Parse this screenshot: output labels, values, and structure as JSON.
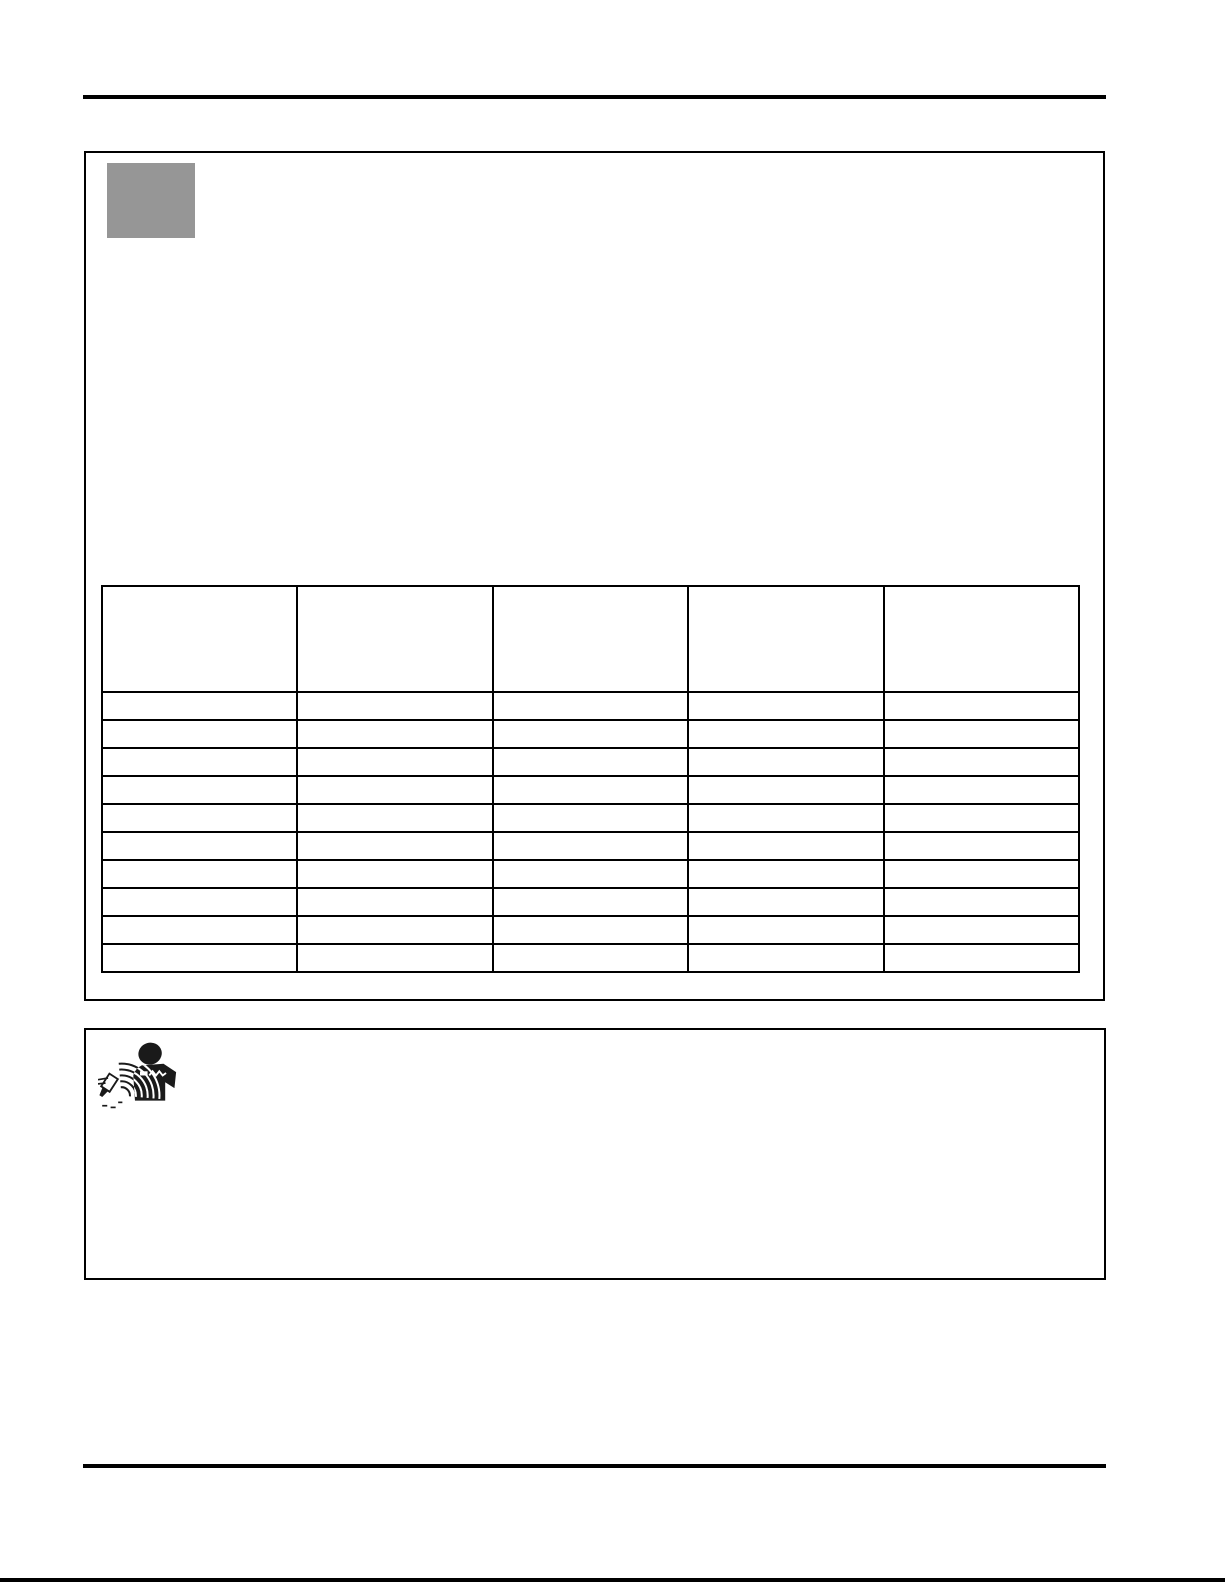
{
  "page": {
    "kind": "scanned-manual-page",
    "visible_text": ""
  },
  "colors": {
    "page_white": "#ffffff",
    "rule_black": "#000000",
    "table_border": "#000000",
    "placeholder_gray": "#969696",
    "icon_black": "#1a1a1a"
  },
  "content_box": {
    "image_placeholder": ""
  },
  "spec_table": {
    "columns": [
      "",
      "",
      "",
      "",
      ""
    ],
    "rows": [
      [
        "",
        "",
        "",
        "",
        ""
      ],
      [
        "",
        "",
        "",
        "",
        ""
      ],
      [
        "",
        "",
        "",
        "",
        ""
      ],
      [
        "",
        "",
        "",
        "",
        ""
      ],
      [
        "",
        "",
        "",
        "",
        ""
      ],
      [
        "",
        "",
        "",
        "",
        ""
      ],
      [
        "",
        "",
        "",
        "",
        ""
      ],
      [
        "",
        "",
        "",
        "",
        ""
      ],
      [
        "",
        "",
        "",
        "",
        ""
      ],
      [
        "",
        "",
        "",
        "",
        ""
      ]
    ]
  },
  "warning_box": {
    "icon": "noise-hazard-icon",
    "icon_description": "person-from-behind-with-jackhammer-sound-waves",
    "text": ""
  }
}
